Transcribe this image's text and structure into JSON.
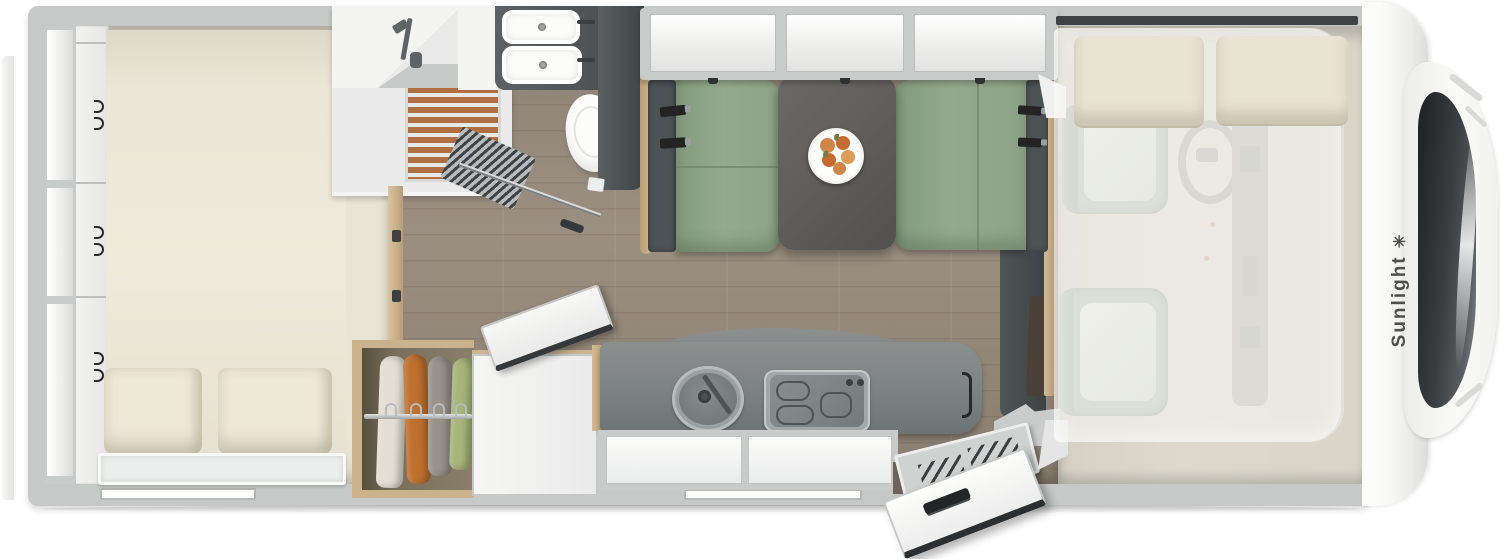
{
  "brand": {
    "name": "Sunlight",
    "logo_glyph": "✳"
  },
  "palette": {
    "wall": "#c7c9c8",
    "floor_bedroom": "#e9e4d5",
    "floor_bedroom_shadow": "#d7d2c2",
    "floor_cab": "#ddd9cd",
    "panel_white": "#f4f4f3",
    "cabinet_frame": "#c9cbca",
    "cream_bed": "#ebe6d7",
    "pillow": "#eee8d9",
    "green_seat": "#8da287",
    "seat_back": "#4d5254",
    "table": "#605e5b",
    "counter": "#7c8182",
    "steel": "#9ba1a3",
    "tan_wood": "#d3bb95",
    "slat_orange": "#b06f42",
    "belt_black": "#232323",
    "plate_white": "#fdfdfc",
    "fruit_a": "#d08648",
    "fruit_b": "#c6692f",
    "fruit_c": "#dc9a55",
    "leaf_green": "#6f7f4a",
    "cloth_1": "#e3dfd4",
    "cloth_2": "#c0702e",
    "cloth_3": "#97938b",
    "cloth_4": "#a8b47a",
    "tv_brown": "#4a4038",
    "red_dot": "#c0392b",
    "brand_text": "#4e4e4e"
  }
}
